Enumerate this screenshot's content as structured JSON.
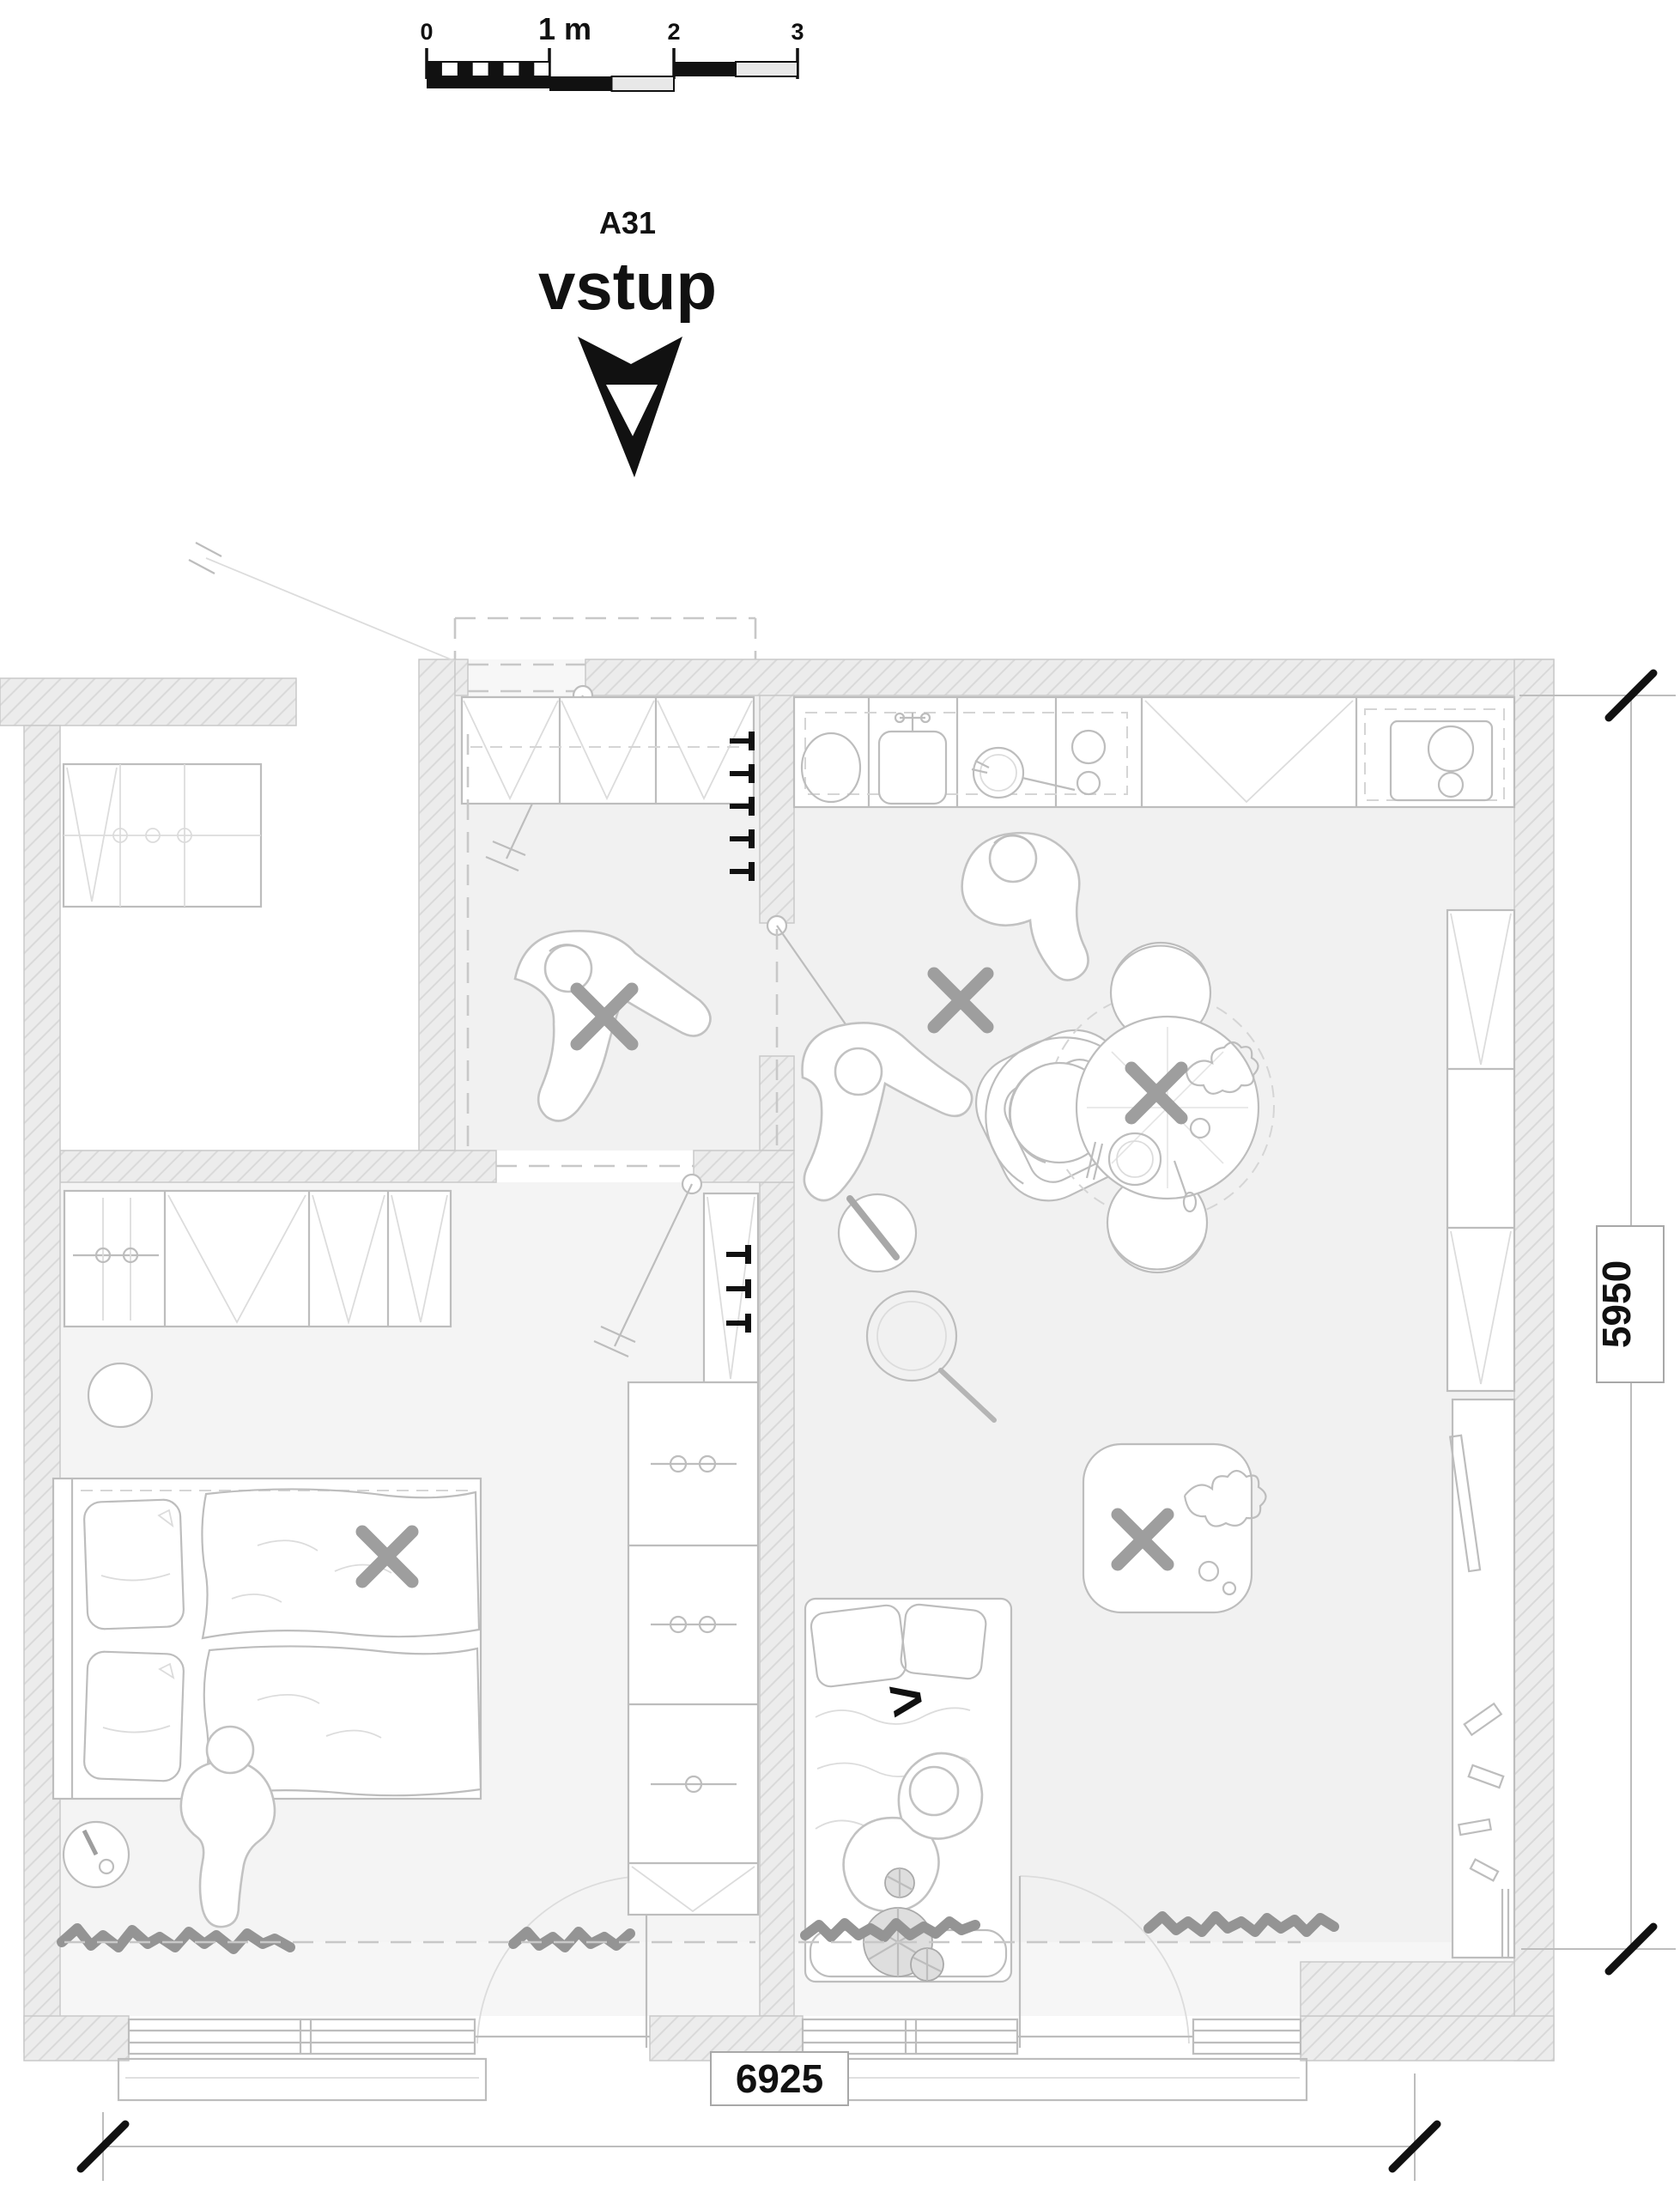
{
  "scale_bar": {
    "labels": [
      "0",
      "1 m",
      "2",
      "3"
    ]
  },
  "entrance": {
    "code": "A31",
    "label": "vstup"
  },
  "dimensions": {
    "bottom_width": "6925",
    "right_height": "5950"
  },
  "markers": {
    "view_direction": ">"
  },
  "colors": {
    "ink": "#111111",
    "wall_fill": "#ececec",
    "hatch_line": "#d9d9d9",
    "floor": "#f1f1f1",
    "bedroom_floor": "#f4f4f4",
    "drawing_line": "#bdbdbd",
    "gray_accent": "#9e9e9e"
  }
}
